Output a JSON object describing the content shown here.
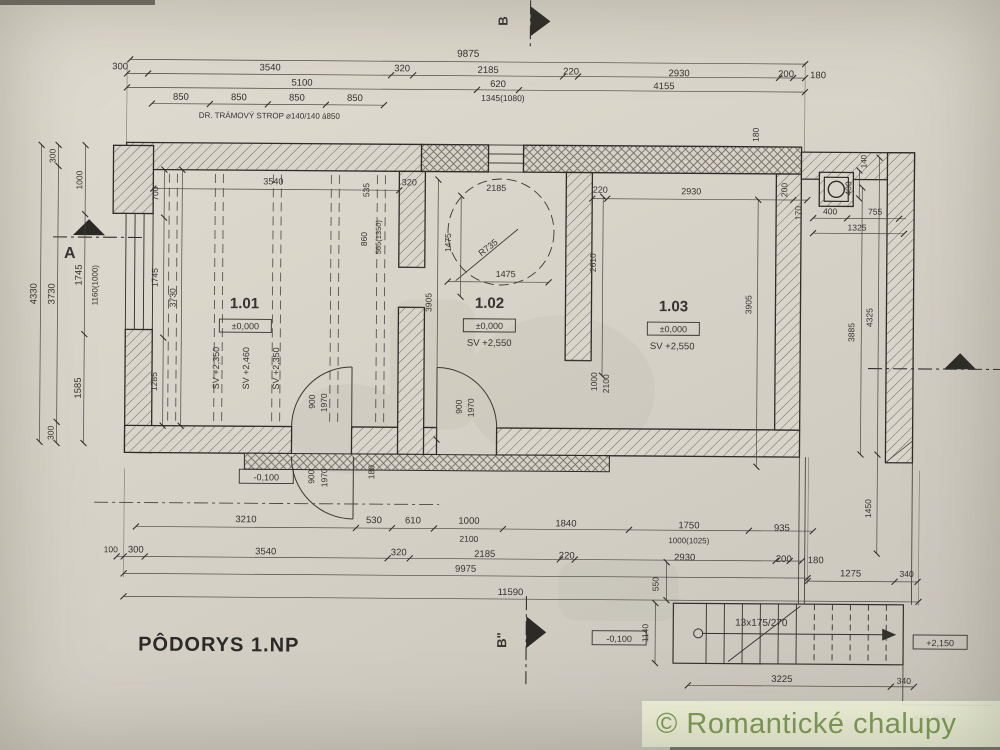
{
  "page": {
    "title": "PÔDORYS 1.NP",
    "watermark": "© Romantické chalupy"
  },
  "drawing": {
    "rooms": [
      {
        "number": "1.01",
        "level": "±0,000",
        "ceiling_height": "SV +2,460",
        "beam_soffit": "SV +2,350"
      },
      {
        "number": "1.02",
        "level": "±0,000",
        "ceiling_height": "SV +2,550"
      },
      {
        "number": "1.03",
        "level": "±0,000",
        "ceiling_height": "SV +2,550"
      }
    ],
    "notes": {
      "beam_note": "DR. TRÁMOVÝ STROP ⌀140/140 á850",
      "stair_note": "13x175/270",
      "wall_note": "KAM. MÚR"
    },
    "annotations": {
      "dims_top": [
        {
          "t": "9875",
          "x": 466,
          "y": 57,
          "s": 10
        },
        {
          "t": "300",
          "x": 118,
          "y": 72
        },
        {
          "t": "3540",
          "x": 268,
          "y": 72
        },
        {
          "t": "320",
          "x": 400,
          "y": 72
        },
        {
          "t": "2185",
          "x": 486,
          "y": 73
        },
        {
          "t": "220",
          "x": 569,
          "y": 74
        },
        {
          "t": "2930",
          "x": 677,
          "y": 75
        },
        {
          "t": "200",
          "x": 784,
          "y": 75
        },
        {
          "t": "180",
          "x": 816,
          "y": 76
        },
        {
          "t": "5100",
          "x": 300,
          "y": 87
        },
        {
          "t": "620",
          "x": 496,
          "y": 87
        },
        {
          "t": "4155",
          "x": 662,
          "y": 88
        },
        {
          "t": "1345(1080)",
          "x": 501,
          "y": 101,
          "s": 8.5
        },
        {
          "t": "850",
          "x": 179,
          "y": 102
        },
        {
          "t": "850",
          "x": 237,
          "y": 102
        },
        {
          "t": "850",
          "x": 295,
          "y": 102
        },
        {
          "t": "850",
          "x": 353,
          "y": 102
        },
        {
          "t": "DR. TRÁMOVÝ STROP ⌀140/140 á850",
          "x": 197,
          "y": 120,
          "a": "start",
          "s": 8
        }
      ],
      "dims_left": [
        {
          "t": "4330",
          "x": 36,
          "y": 297,
          "r": -90
        },
        {
          "t": "300",
          "x": 54,
          "y": 159,
          "r": -90,
          "s": 8.5
        },
        {
          "t": "3730",
          "x": 54,
          "y": 297,
          "r": -90
        },
        {
          "t": "300",
          "x": 54,
          "y": 436,
          "r": -90,
          "s": 8.5
        },
        {
          "t": "1000",
          "x": 81,
          "y": 183,
          "r": -90,
          "s": 8.5
        },
        {
          "t": "1745",
          "x": 81,
          "y": 278,
          "r": -90
        },
        {
          "t": "1585",
          "x": 81,
          "y": 391,
          "r": -90
        },
        {
          "t": "1160(1000)",
          "x": 97,
          "y": 288,
          "r": -90,
          "s": 8
        }
      ],
      "dims_right": [
        {
          "t": "180",
          "x": 757,
          "y": 133,
          "r": -90,
          "s": 8.5
        },
        {
          "t": "140",
          "x": 865,
          "y": 159,
          "r": -90,
          "s": 8
        },
        {
          "t": "400",
          "x": 850,
          "y": 186,
          "r": -90,
          "s": 8.5
        },
        {
          "t": "170",
          "x": 800,
          "y": 211,
          "r": -90,
          "s": 8.5
        },
        {
          "t": "400",
          "x": 829,
          "y": 212,
          "s": 8.5
        },
        {
          "t": "755",
          "x": 874,
          "y": 212,
          "s": 8.5
        },
        {
          "t": "1325",
          "x": 856,
          "y": 228,
          "s": 8.5
        },
        {
          "t": "3885",
          "x": 854,
          "y": 330,
          "r": -90,
          "s": 8.5
        },
        {
          "t": "4325",
          "x": 872,
          "y": 315,
          "r": -90,
          "s": 8.5
        },
        {
          "t": "1450",
          "x": 872,
          "y": 506,
          "r": -90,
          "s": 8.5
        }
      ],
      "interior_101": [
        {
          "t": "700",
          "x": 157,
          "y": 196,
          "r": -90,
          "s": 8.5
        },
        {
          "t": "1745",
          "x": 157,
          "y": 280,
          "r": -90,
          "s": 8.5
        },
        {
          "t": "1285",
          "x": 157,
          "y": 384,
          "r": -90,
          "s": 8.5
        },
        {
          "t": "3730",
          "x": 175,
          "y": 300,
          "r": -90,
          "s": 8.5
        },
        {
          "t": "3540",
          "x": 272,
          "y": 186,
          "s": 9
        },
        {
          "t": "535",
          "x": 368,
          "y": 191,
          "r": -90,
          "s": 8.5
        },
        {
          "t": "860",
          "x": 366,
          "y": 240,
          "r": -90,
          "s": 8.5
        },
        {
          "t": "565(1350)",
          "x": 380,
          "y": 238,
          "r": -90,
          "s": 7.5
        },
        {
          "t": "320",
          "x": 408,
          "y": 186,
          "s": 9
        },
        {
          "t": "SV +2,350",
          "x": 219,
          "y": 370,
          "r": -90,
          "s": 9
        },
        {
          "t": "SV +2,460",
          "x": 249,
          "y": 370,
          "r": -90,
          "s": 9
        },
        {
          "t": "SV +2,350",
          "x": 279,
          "y": 370,
          "r": -90,
          "s": 9
        },
        {
          "t": "900",
          "x": 315,
          "y": 403,
          "r": -90,
          "s": 8.5
        },
        {
          "t": "1970",
          "x": 327,
          "y": 404,
          "r": -90,
          "s": 8.5
        },
        {
          "t": "900",
          "x": 315,
          "y": 478,
          "r": -90,
          "s": 8.5
        },
        {
          "t": "1970",
          "x": 328,
          "y": 479,
          "r": -90,
          "s": 8.5
        },
        {
          "t": "-0,100",
          "x": 267,
          "y": 482,
          "s": 9
        },
        {
          "t": "180",
          "x": 375,
          "y": 473,
          "r": -90,
          "s": 8.5
        }
      ],
      "interior_102": [
        {
          "t": "2185",
          "x": 495,
          "y": 191,
          "s": 9
        },
        {
          "t": "1475",
          "x": 450,
          "y": 243,
          "r": -90,
          "s": 8.5
        },
        {
          "t": "R735",
          "x": 489,
          "y": 250,
          "r": -38,
          "s": 9
        },
        {
          "t": "1475",
          "x": 505,
          "y": 277,
          "s": 9
        },
        {
          "t": "3905",
          "x": 431,
          "y": 303,
          "r": -90,
          "s": 8.5
        },
        {
          "t": "2610",
          "x": 595,
          "y": 262,
          "r": -90,
          "s": 8.5
        },
        {
          "t": "900",
          "x": 462,
          "y": 407,
          "r": -90,
          "s": 8.5
        },
        {
          "t": "1970",
          "x": 474,
          "y": 408,
          "r": -90,
          "s": 8.5
        },
        {
          "t": "1000",
          "x": 597,
          "y": 381,
          "r": -90,
          "s": 8.5
        },
        {
          "t": "2100",
          "x": 609,
          "y": 383,
          "r": -90,
          "s": 8.5
        }
      ],
      "interior_103": [
        {
          "t": "220",
          "x": 599,
          "y": 192,
          "s": 9
        },
        {
          "t": "2930",
          "x": 690,
          "y": 193,
          "s": 9
        },
        {
          "t": "200",
          "x": 786,
          "y": 188,
          "r": -90,
          "s": 8.5
        },
        {
          "t": "3905",
          "x": 751,
          "y": 303,
          "r": -90,
          "s": 8.5
        }
      ],
      "room_labels": [
        {
          "t": "1.01",
          "x": 244,
          "y": 310,
          "s": 15,
          "w": "bold"
        },
        {
          "t": "±0,000",
          "x": 245,
          "y": 331,
          "s": 9
        },
        {
          "t": "1.02",
          "x": 489,
          "y": 308,
          "s": 15,
          "w": "bold"
        },
        {
          "t": "±0,000",
          "x": 489,
          "y": 329,
          "s": 9
        },
        {
          "t": "SV +2,550",
          "x": 489,
          "y": 346,
          "s": 9.5
        },
        {
          "t": "1.03",
          "x": 673,
          "y": 310,
          "s": 15,
          "w": "bold"
        },
        {
          "t": "±0,000",
          "x": 673,
          "y": 331,
          "s": 9
        },
        {
          "t": "SV +2,550",
          "x": 672,
          "y": 348,
          "s": 9.5
        }
      ],
      "dims_bottom": [
        {
          "t": "3210",
          "x": 247,
          "y": 524
        },
        {
          "t": "530",
          "x": 375,
          "y": 524
        },
        {
          "t": "610",
          "x": 414,
          "y": 524
        },
        {
          "t": "1000",
          "x": 470,
          "y": 524
        },
        {
          "t": "1840",
          "x": 567,
          "y": 526
        },
        {
          "t": "1750",
          "x": 690,
          "y": 527
        },
        {
          "t": "935",
          "x": 783,
          "y": 529
        },
        {
          "t": "2100",
          "x": 470,
          "y": 542,
          "s": 8.5
        },
        {
          "t": "1000(1025)",
          "x": 690,
          "y": 542,
          "s": 8
        },
        {
          "t": "100",
          "x": 112,
          "y": 555,
          "s": 8.5
        },
        {
          "t": "300",
          "x": 137,
          "y": 555
        },
        {
          "t": "3540",
          "x": 267,
          "y": 556
        },
        {
          "t": "320",
          "x": 400,
          "y": 556
        },
        {
          "t": "2185",
          "x": 486,
          "y": 557
        },
        {
          "t": "220",
          "x": 568,
          "y": 558
        },
        {
          "t": "2930",
          "x": 686,
          "y": 559
        },
        {
          "t": "200",
          "x": 785,
          "y": 560
        },
        {
          "t": "180",
          "x": 817,
          "y": 561
        },
        {
          "t": "9975",
          "x": 467,
          "y": 572
        },
        {
          "t": "1275",
          "x": 852,
          "y": 574
        },
        {
          "t": "340",
          "x": 908,
          "y": 574,
          "s": 8.5
        },
        {
          "t": "11590",
          "x": 512,
          "y": 595
        },
        {
          "t": "550",
          "x": 660,
          "y": 583,
          "r": -90,
          "s": 8.5
        }
      ],
      "stair": [
        {
          "t": "-0,100",
          "x": 621,
          "y": 641,
          "s": 9
        },
        {
          "t": "1140",
          "x": 650,
          "y": 632,
          "r": -90,
          "s": 8.5
        },
        {
          "t": "13x175/270",
          "x": 763,
          "y": 624,
          "s": 10
        },
        {
          "t": "3225",
          "x": 784,
          "y": 680
        },
        {
          "t": "340",
          "x": 906,
          "y": 681,
          "s": 8.5
        },
        {
          "t": "+2,150",
          "x": 942,
          "y": 643,
          "s": 9
        },
        {
          "t": "KAM. MÚR",
          "x": 934,
          "y": 717,
          "s": 7
        }
      ],
      "markers": [
        {
          "t": "A",
          "x": 69,
          "y": 261,
          "s": 16,
          "w": "bold"
        },
        {
          "t": "B",
          "x": 505,
          "y": 21,
          "r": -90,
          "s": 13,
          "w": "bold"
        },
        {
          "t": "B\"",
          "x": 508,
          "y": 640,
          "r": -90,
          "s": 13,
          "w": "bold"
        }
      ]
    }
  }
}
